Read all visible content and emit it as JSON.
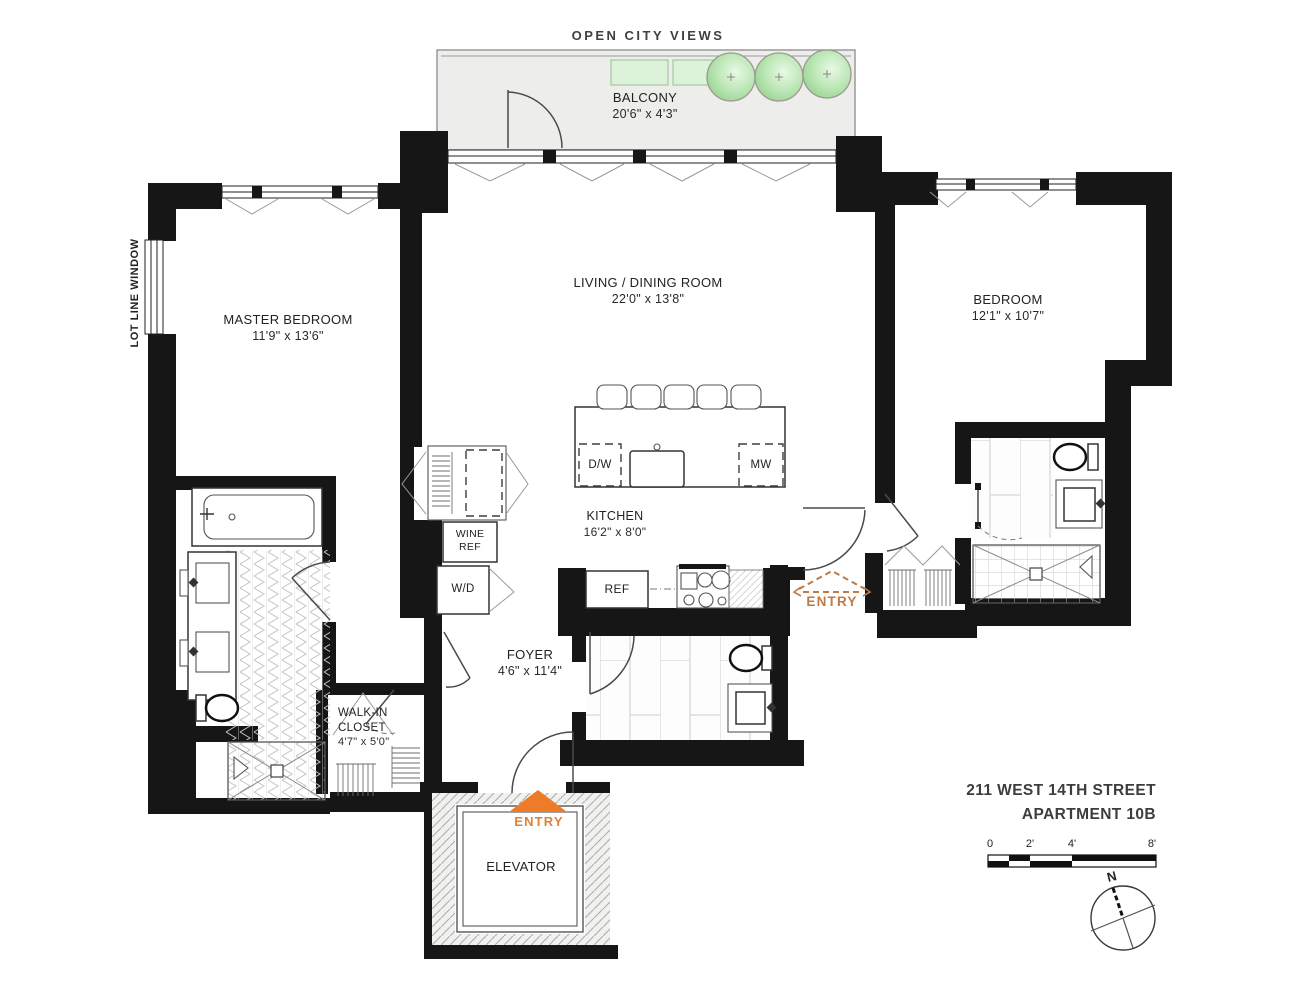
{
  "plan": {
    "header": {
      "open_city_views": "OPEN CITY VIEWS"
    },
    "balcony": {
      "name": "BALCONY",
      "dims": "20'6\" x 4'3\""
    },
    "rooms": {
      "master_bedroom": {
        "name": "MASTER BEDROOM",
        "dims": "11'9\" x 13'6\""
      },
      "living_dining": {
        "name": "LIVING / DINING ROOM",
        "dims": "22'0\" x 13'8\""
      },
      "bedroom": {
        "name": "BEDROOM",
        "dims": "12'1\" x 10'7\""
      },
      "kitchen": {
        "name": "KITCHEN",
        "dims": "16'2\" x 8'0\""
      },
      "foyer": {
        "name": "FOYER",
        "dims": "4'6\" x 11'4\""
      },
      "walk_in_closet": {
        "name": "WALK-IN CLOSET",
        "dims": "4'7\" x 5'0\""
      },
      "elevator": {
        "name": "ELEVATOR"
      }
    },
    "appliances": {
      "dw": "D/W",
      "mw": "MW",
      "ref": "REF",
      "wine_ref": "WINE REF",
      "wd": "W/D"
    },
    "annotations": {
      "lot_line_window": "LOT LINE WINDOW",
      "entry_main": "ENTRY",
      "entry_side": "ENTRY"
    },
    "title": {
      "line1": "211 WEST 14TH STREET",
      "line2": "APARTMENT 10B"
    },
    "scale_bar": {
      "ticks": [
        "0",
        "2'",
        "4'",
        "8'"
      ]
    },
    "compass": {
      "north_label": "N"
    },
    "colors": {
      "wall": "#161616",
      "entry_orange": "#ed7b28",
      "entry_side_orange": "#bf7a45",
      "tree_green": "#8fce8a",
      "planter_green": "#dcf3da",
      "balcony_fill": "#ededeb"
    }
  }
}
